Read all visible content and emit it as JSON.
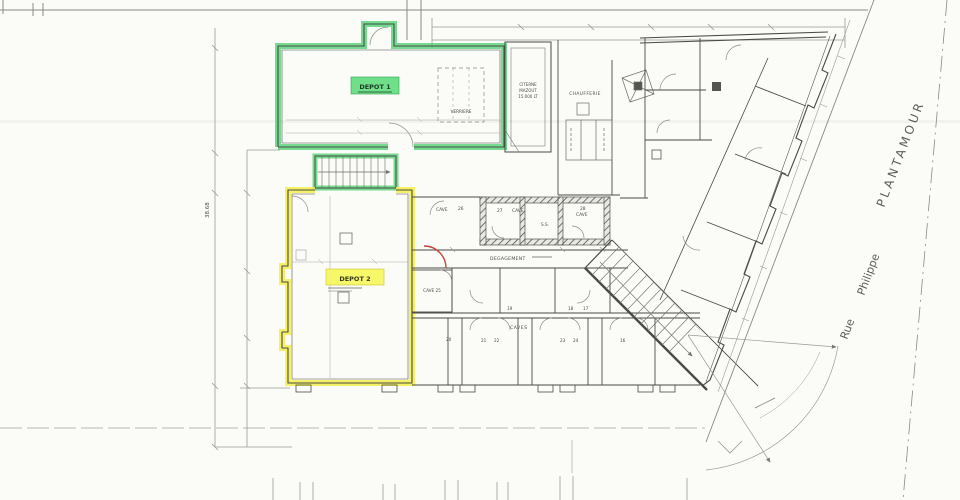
{
  "drawing": {
    "type": "architectural-basement-floor-plan",
    "colors": {
      "paper": "#fbfbf8",
      "line_dark": "#4a4a46",
      "line_faint": "#9a9a94",
      "highlight_green": "#4ad06e",
      "highlight_yellow": "#f2ef4d",
      "accent_red": "#c4453a"
    },
    "labels": {
      "depot1": "DEPOT 1",
      "depot2": "DEPOT 2",
      "verriere": "VERRIERE",
      "citerne_l1": "CITERNE",
      "citerne_l2": "MAZOUT",
      "citerne_l3": "15.000 LT",
      "chaufferie": "CHAUFFERIE",
      "degagement": "DEGAGEMENT",
      "caves": "CAVES",
      "cave_label": "CAVE",
      "cave25": "CAVE 25",
      "ss": "S.S.",
      "num16": "16",
      "num17": "17",
      "num18": "18",
      "num19": "19",
      "num20": "20",
      "num21": "21",
      "num22": "22",
      "num23": "23",
      "num24": "24",
      "num26": "26",
      "num27": "27",
      "num28": "28"
    },
    "street": {
      "line1": "Rue",
      "line2": "Philippe",
      "line3": "PLANTAMOUR"
    },
    "dimensions": {
      "left_total": "38.68"
    }
  }
}
